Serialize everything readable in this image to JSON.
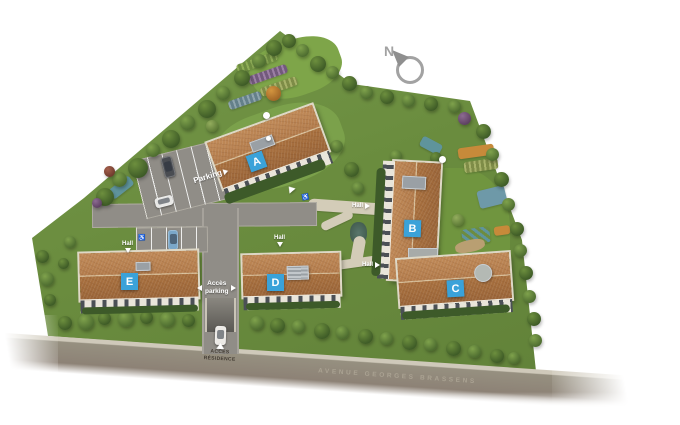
{
  "title": "Plan masse de la résidence",
  "compass": {
    "label": "N"
  },
  "buildings": [
    {
      "id": "A",
      "label": "A"
    },
    {
      "id": "B",
      "label": "B"
    },
    {
      "id": "C",
      "label": "C"
    },
    {
      "id": "D",
      "label": "D"
    },
    {
      "id": "E",
      "label": "E"
    }
  ],
  "markers": {
    "parking": {
      "label": "Parking"
    },
    "halls": [
      {
        "building": "A",
        "arrow": "up-left"
      },
      {
        "building": "B",
        "label": "Hall",
        "arrow": "right"
      },
      {
        "building": "B-C",
        "label": "Hall",
        "arrow": "right"
      },
      {
        "building": "D",
        "label": "Hall",
        "arrow": "down"
      },
      {
        "building": "E",
        "label": "Hall",
        "arrow": "down"
      }
    ],
    "acces_parking": {
      "line1": "Accès",
      "line2": "parking"
    },
    "acces_residence": {
      "line1": "ACCÈS",
      "line2": "RÉSIDENCE"
    }
  },
  "street": {
    "name": "AVENUE GEORGES BRASSENS"
  },
  "colors": {
    "label_blue": "#3aa2d9",
    "roof_terracotta": "#b07a4a",
    "grass_green": "#6a8c3e",
    "road_gray": "#908d87",
    "avenue_text": "#aaa292",
    "acces_residence_text": "#423b32"
  }
}
